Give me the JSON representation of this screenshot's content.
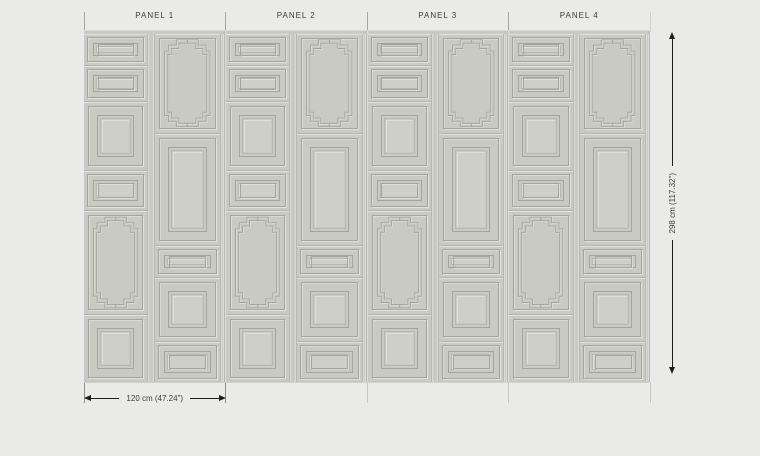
{
  "colors": {
    "page_bg": "#eaeae8",
    "panel_base": "#c8cac3",
    "panel_light": "#cdcfc8",
    "molding_line_dark": "#a4a69e",
    "molding_line_mid": "#b7b9b1",
    "seam": "#b3b5ae",
    "dimension_line": "#1e1e1e",
    "text": "#3c3c3c"
  },
  "panels": [
    {
      "label": "PANEL 1"
    },
    {
      "label": "PANEL 2"
    },
    {
      "label": "PANEL 3"
    },
    {
      "label": "PANEL 4"
    }
  ],
  "dimensions": {
    "width_label": "120 cm (47.24\")",
    "height_label": "298 cm (117.32\")"
  },
  "pattern": {
    "left_column": [
      {
        "type": "plain",
        "size": "small",
        "h": 32
      },
      {
        "type": "plain",
        "size": "small",
        "h": 35
      },
      {
        "type": "plain",
        "size": "large",
        "h": 69
      },
      {
        "type": "plain",
        "size": "small",
        "h": 40
      },
      {
        "type": "ornate",
        "size": "",
        "h": 105
      },
      {
        "type": "plain",
        "size": "large",
        "h": 68
      }
    ],
    "right_column": [
      {
        "type": "ornate",
        "size": "",
        "h": 100
      },
      {
        "type": "plain",
        "size": "large",
        "h": 113
      },
      {
        "type": "plain",
        "size": "small",
        "h": 32
      },
      {
        "type": "plain",
        "size": "large",
        "h": 63
      },
      {
        "type": "plain",
        "size": "small",
        "h": 41
      }
    ]
  }
}
